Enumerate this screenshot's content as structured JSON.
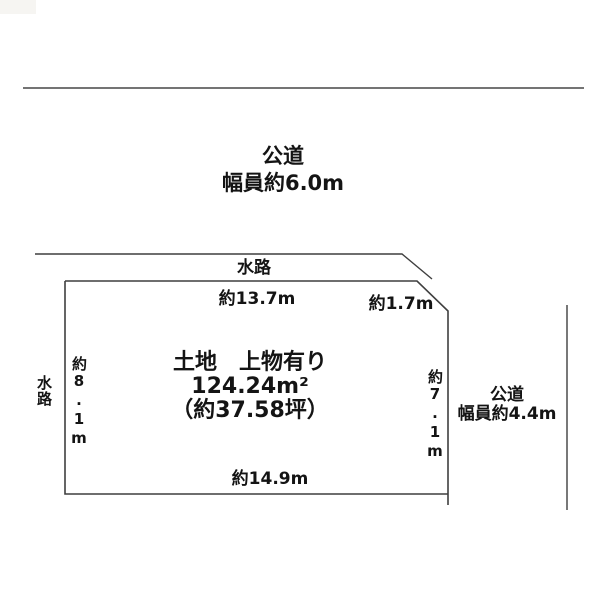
{
  "top_road": {
    "name": "公道",
    "width": "幅員約6.0m"
  },
  "waterway_top": "水路",
  "waterway_left": "水路",
  "right_road": {
    "name": "公道",
    "width": "幅員約4.4m"
  },
  "parcel": {
    "title": "土地　上物有り",
    "area_sqm": "124.24m²",
    "area_tsubo": "（約37.58坪）"
  },
  "dimensions": {
    "top": "約13.7m",
    "top_right": "約1.7m",
    "left": "約8.1m",
    "right": "約7.1m",
    "bottom": "約14.9m"
  },
  "colors": {
    "line": "#3f3f3f",
    "text": "#141414",
    "background": "#ffffff"
  }
}
